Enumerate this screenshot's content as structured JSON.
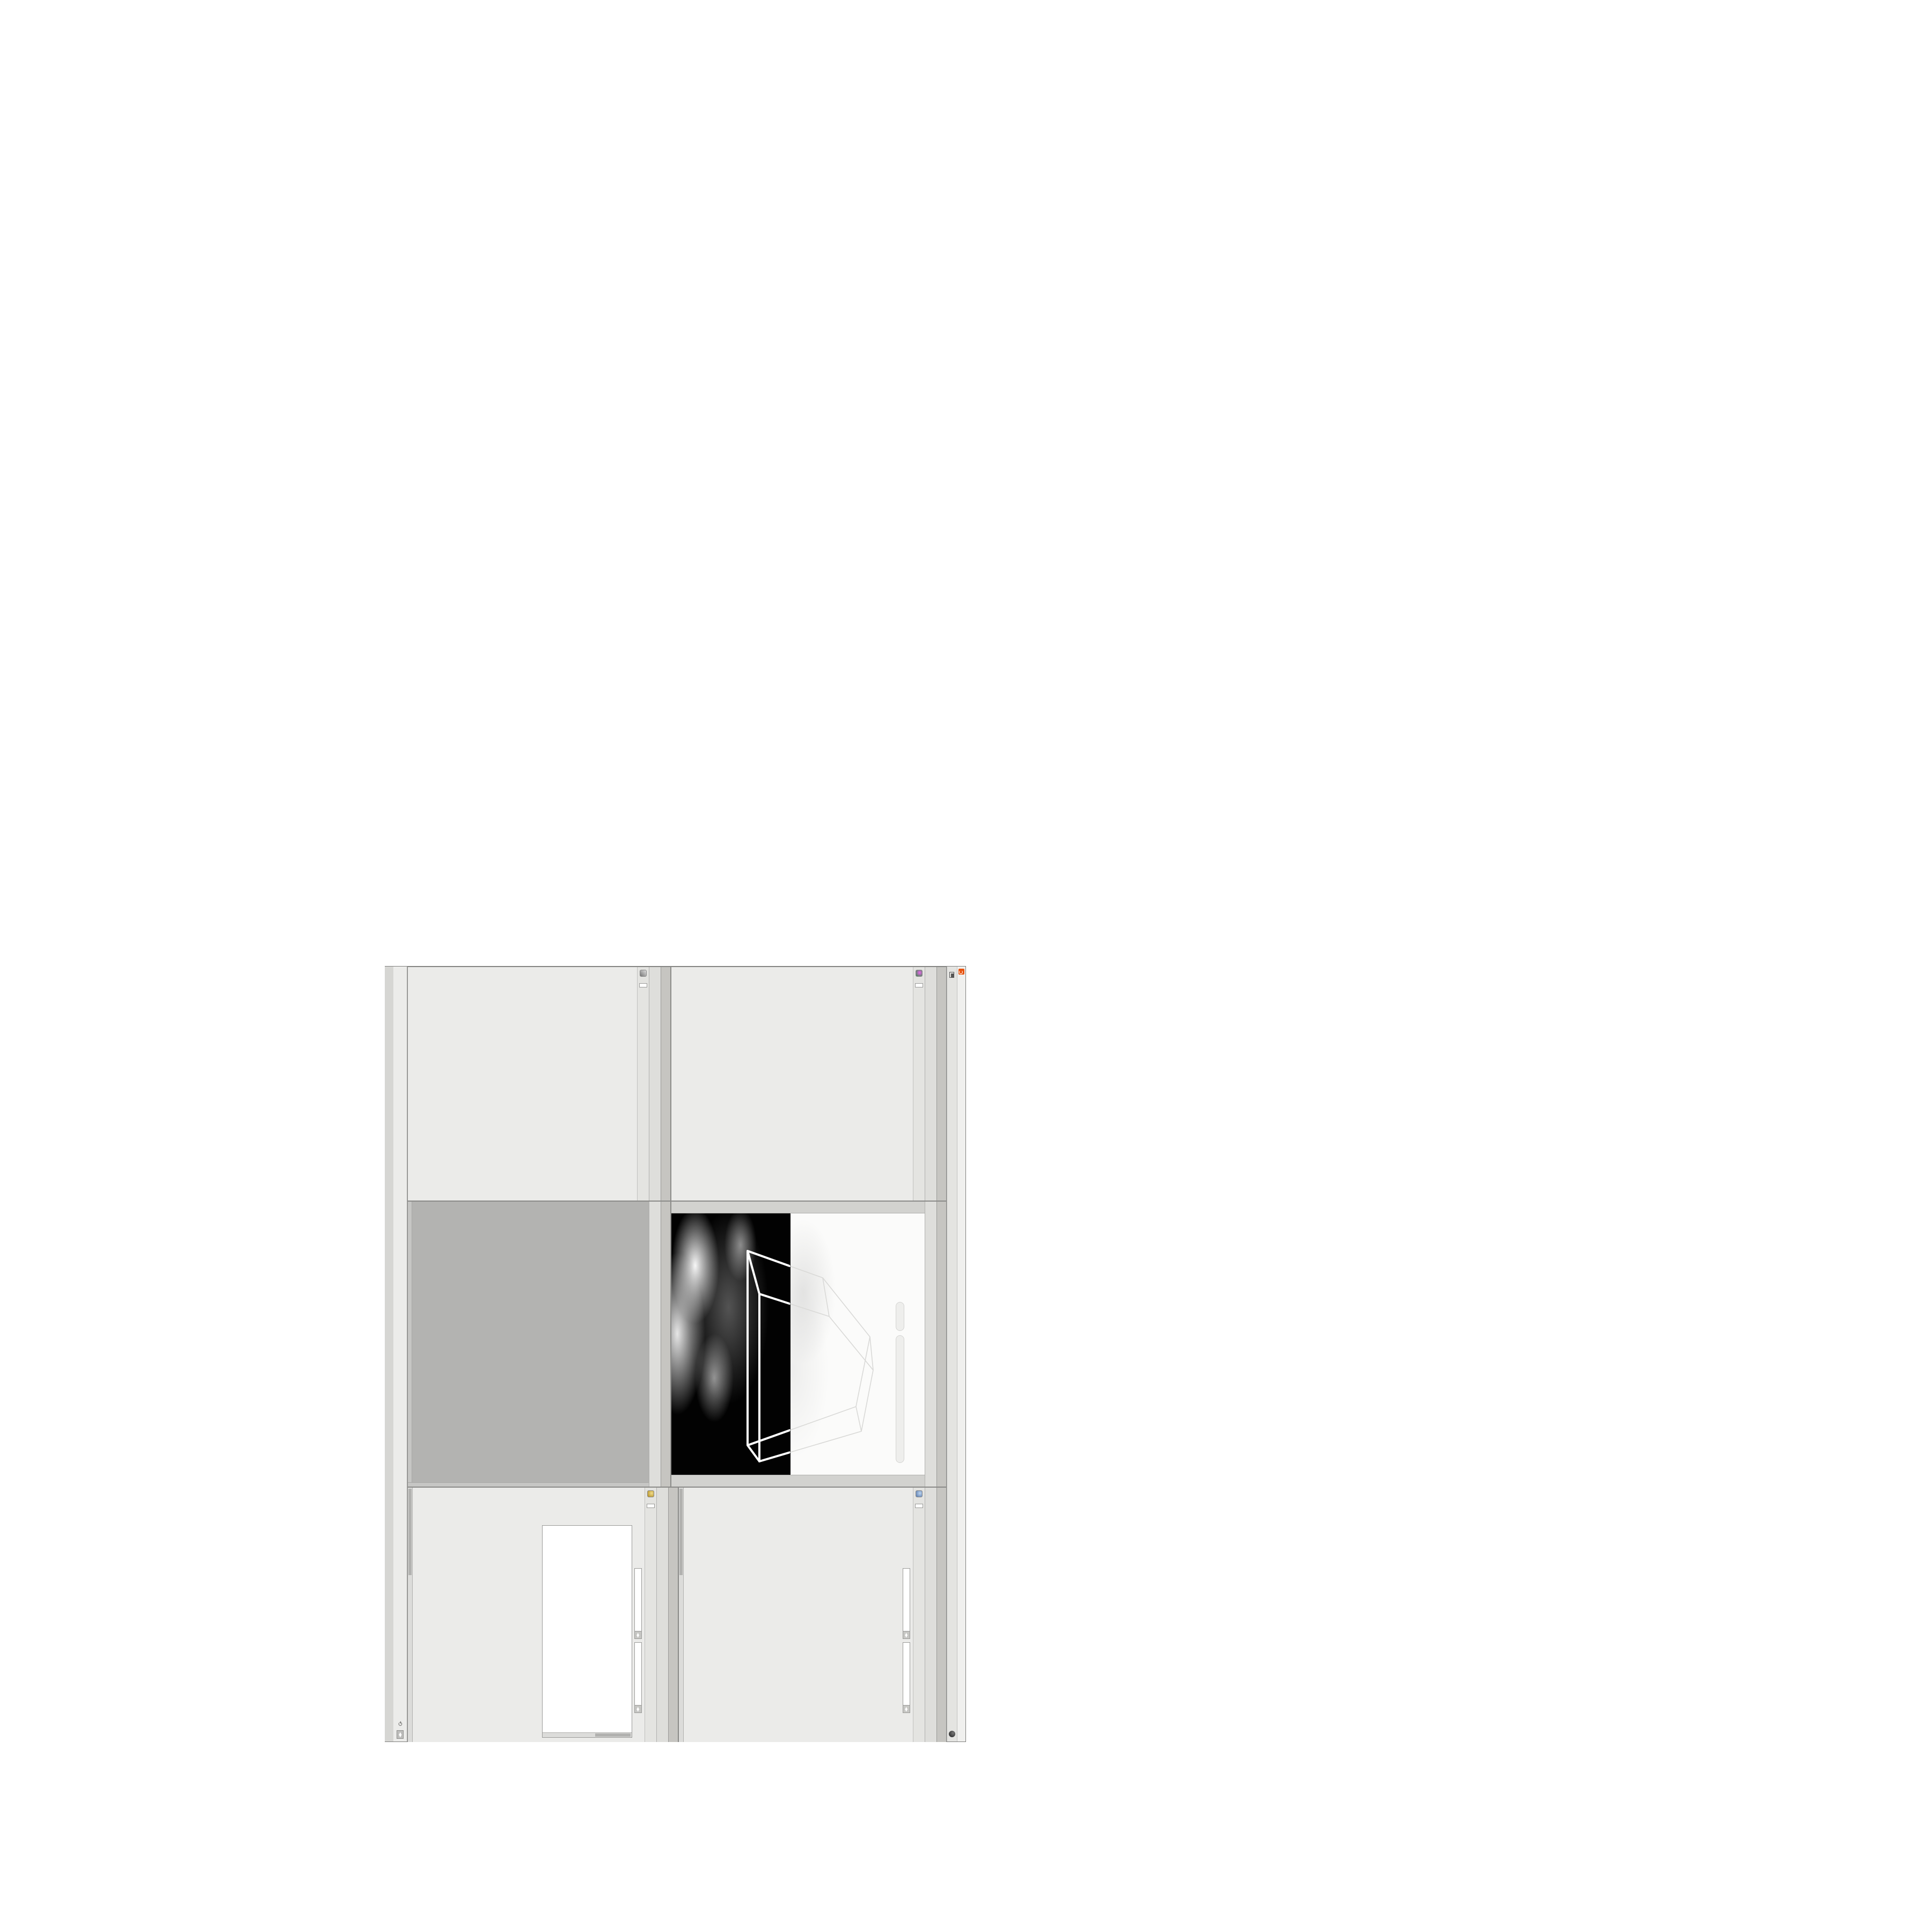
{
  "window": {
    "title": "C:/O/O_AIDIV_O_VIDIA_O/O_INIDUOH_O_HOUDINI_O/O_5_71_O_17_5_O/O_PIH_O_HIP_O/PIH.O___#5_71#___#WOLG#_#BDV#___O___#VDB#_#GLOW#___#17_5#___O.HIP - Houdini FX 17.5.460",
    "menu": [
      "File",
      "Edit",
      "Render",
      "Assets",
      "Windows",
      "Help"
    ],
    "desktop_label": "O",
    "right_label": "Main",
    "buttons": [
      "–",
      "❐",
      "✕"
    ]
  },
  "breadcrumb": {
    "root": "obj",
    "path": "O_YRTEMOEG_O_GEOMETRY_O"
  },
  "nav_icons": [
    "*",
    "H",
    "○",
    "i",
    "?"
  ],
  "statusbar": {
    "message": "Successfully saved PIH.O___#5_71#___#WOLG#_#BDV#___O___#VDB#_#GLOW#___#17_5#___O.HIP (Thu Feb 4 10:46:01 2021)",
    "auto_update": "Auto Update"
  },
  "volviz": {
    "tabs": [
      "O____ARTNAM_...",
      "O____AREMAC_...",
      "O_NOITAZILAUSIV..."
    ],
    "active_tab": 2,
    "node_type": "Volume Visualization",
    "node_name": "O_NOITAZILAUSIV_EMULO",
    "rows1": [
      {
        "label": "Density Field",
        "value": "density",
        "w": 130
      },
      {
        "label": "Mode",
        "value": "Clamped...",
        "dd": true,
        "w": 92,
        "extra": "Density",
        "btn": "Presets"
      }
    ],
    "ramp1_label": "Density Ramp",
    "rows2": [
      {
        "label": "Diffuse Field",
        "value": "density",
        "w": 130
      },
      {
        "label": "Mode",
        "value": "Clamped R...",
        "dd": true,
        "w": 92,
        "extra": "Diffuse",
        "btn": "Presets"
      },
      {
        "label": "Diffuse Range",
        "value": "0",
        "value2": "1",
        "w": 44,
        "dim": true
      }
    ],
    "ramp2_label": "Diffuse Ramp",
    "rows3": [
      {
        "label": "Point No.",
        "value": "1",
        "w": 56,
        "slider": 0.06
      },
      {
        "label": "Position",
        "value": "0",
        "w": 56,
        "slider": 0.04
      },
      {
        "label": "Color",
        "swatch": true
      }
    ],
    "hsv": [
      {
        "label": "H",
        "value": "0",
        "ramp": "hue"
      },
      {
        "label": "S",
        "value": "0",
        "ramp": "sat"
      },
      {
        "label": "V",
        "value": "1.8125",
        "ramp": "val"
      }
    ],
    "rows4": [
      {
        "label": "Interpolation",
        "value": "Linear",
        "dd": true,
        "w": 104
      }
    ]
  },
  "switchpane": {
    "tabs": [
      "O_HCTIWS_NOITAZILAUSIV_ECILS_ELDIM_O_MIDLE_SLICE_VISUAL..."
    ],
    "active_tab": 0,
    "node_type": "Switch",
    "node_name": "O_HCTIWS_NOITAZILAUSIV_ECILS_EL",
    "list_label": "Input Operators (Drag/Drop to reorder)",
    "inputs": [
      "O_NOITAZILAUSIV_EMULOV_O_VOLUME_VISUALIZATION_O",
      "O_MROFSNART_ECILS_ELDIM_O_MIDLE_SLICE_TRANSFORM_O"
    ],
    "select": {
      "label": "Select Input",
      "value": "0",
      "w": 50,
      "slider": 0.03
    }
  },
  "viewport": {
    "tab": "Main",
    "ortho_pill": "Ortho ▾",
    "camera_pill": "O____AREMAC____O____CAMERA____O ▾",
    "left_toolbar": [
      "view-light-a",
      "view-light-b",
      "view-light-c",
      "select-tool",
      "translate-tool",
      "rotate-tool",
      "scale-tool",
      "handles-tool",
      "snap-magnet",
      "snap-grid",
      "secure-selection"
    ],
    "right_toolbar": [
      "camera-lock",
      "quadview-grid",
      "display-points",
      "display-wire",
      "display-shaded",
      "display-volume",
      "grid-toggle",
      "ruler-tool",
      "light-toggle",
      "material-toggle"
    ]
  },
  "network": {
    "tabs": [
      "O_YRTEMOEG_O_GEOMETRY_O"
    ],
    "active_tab": 0,
    "watermark": "Geometry",
    "nodes": [
      {
        "type": "an_CubeSphere",
        "name": "O_EREHPS_EBUC_O_CUBE_SPHERE_O",
        "c": "#4a8f5a"
      },
      {
        "type": "PolyWire",
        "name": "O_EMARFERIW_NOGYLOP_EREHPS_EBUC_O_CUBE_SPHERE_POLYGON_WIREFRAME_O",
        "c": "#8a8a88"
      },
      {
        "type": "File",
        "name": "JBO.M03.PETS.TRPG.LS_O_SL.GPRT.STEP.30M.OBJ",
        "c": "#e0893a"
      },
      {
        "type": "Switch",
        "name": "O_HCTIWS_YRTEMOEG_LANRETXE_LANRETNI_O_INTERNAL_EXTERNAL_GEOMETRY_SWITCH_O",
        "c": "#6a6a68"
      },
      {
        "type": "Clip",
        "name": "O_EMULOV_PILC_TNORF_O_FRONT_CLIP_VOLUME_O",
        "c": "#9a9ab8"
      },
      {
        "type": "Clip",
        "name": "O_EMULOV_PILC_KCAB_O_BACK_CLIP_VOLUME_O",
        "c": "#9a9ab8"
      },
      {
        "type": "FLIP Source",
        "name": "O_EMULOV_LEHS_ELCITRAP_TICILPMI_DIULF_O_FLUID_IMPLICIT_PARTICLE_SHEL_VOLUME_O",
        "c": "#f2f2f0"
      },
      {
        "type": "VDB from Polygons",
        "name": "O_SNOGYLOP_YRTEMOEG_MORF_EMULOV_BDV_O_VDB_VOLUME_FROM_GEOMETRY_POLYGONS_O",
        "c": "#9aa7d8"
      },
      {
        "type": "Volume Wrangle",
        "name": "O____ELGNARW_EMULOV____O____VOLUME_WRANGLE____O",
        "c": "#c9a227"
      },
      {
        "type": "Volume Visualization",
        "name": "O_NOITAZILAUSIV_EMULOV_O_VOLUME_VISUALIZATION_O",
        "c": "#cc5577"
      },
      {
        "type": "Transform",
        "name": "O_MROFSNART_ECILS_ELDIM_O_MIDLE_SLICE_TRANSFORM_O",
        "c": "#8a8a88"
      },
      {
        "type": "Switch",
        "name": "O_HCTIWS_NOITAZILAUSIV_ECILS_ELDIM_O_MIDLE_SLICE_VISUALIZATION_SWITCH_O",
        "c": "#6a6a68"
      },
      {
        "type": "Merge",
        "name": "O_ECAFRUS_HTIW_EMULOV_EGREM_O_MERGE_VOLUME_WITH_SURFACE_O",
        "c": "#f2f2f0"
      },
      {
        "type": "Transform",
        "name": "O_MROFSNART_TLUSER_O_RESULT_TRANSFORM_O",
        "c": "#b0b0ae",
        "selected": true
      }
    ]
  },
  "flip": {
    "tabs": [
      "O_EMULOV_LEHS_ELCITRAP_TICILPMI_DIULF_O_FLUID_IMPLICIT_PARTI..."
    ],
    "active_tab": 0,
    "node_type": "FLIP Source",
    "node_name": "O_EMULOV_LEHS_ELCITRAP_TICI",
    "asset_label": "Asset Name and Path",
    "asset_name": "flipsource",
    "asset_path": "C:/O/O_ERAWTF...",
    "rows": [
      {
        "label": "Initialize",
        "value": "Source FLIP",
        "dd": true,
        "w": 104
      },
      {
        "label": "Volume Name",
        "value": "density",
        "w": 140
      },
      {
        "label": "Voxel Size",
        "value": "1/27",
        "w": 76,
        "yellow": true,
        "slider": 0.34,
        "sw": 150
      },
      {
        "label": "Shell Thickness",
        "value": "3",
        "w": 76,
        "slider": 0.56,
        "sw": 150
      },
      {
        "label": "Output Fog",
        "chk": true
      },
      {
        "label": "Fog Boost",
        "value": "0",
        "w": 76,
        "dim": true,
        "slider": 0.05,
        "sw": 150
      }
    ],
    "group_label": "Particles",
    "group_rows": [
      {
        "label": "Create Particles",
        "chk": true,
        "bold": true
      },
      {
        "label": "Particle Group",
        "value": "particles",
        "w": 140,
        "dim": true
      },
      {
        "label": "Particle Separation",
        "value": "1/9",
        "w": 76,
        "dim": true,
        "slider": 0.3,
        "sw": 130
      },
      {
        "label": "Jitter Seed",
        "value": "0",
        "w": 76,
        "dim": true,
        "slider": 0.05,
        "sw": 130
      },
      {
        "label": "Jitter Scale",
        "value": "0",
        "w": 76,
        "dim": true,
        "slider": 0.05,
        "sw": 130
      },
      {
        "label": "Oversampling",
        "value": "2",
        "w": 76,
        "dim": true,
        "slider": 0.12,
        "sw": 130
      },
      {
        "label": "Oversampling Bandwi...",
        "value": "1",
        "w": 76,
        "dim": true,
        "slider": 0.08,
        "sw": 130
      },
      {
        "label": "Velocity",
        "value": "0",
        "w": 76,
        "dim": true
      }
    ],
    "rows_after": [
      {
        "label": "Add Rest Attribute",
        "chk": true
      }
    ]
  },
  "wrangle": {
    "tabs": [
      "O____ELGNARW_EMULOV____O____VOLUME_WRANGL..."
    ],
    "active_tab": 0,
    "node_type": "Volume Wrangle",
    "node_name": "O____ELGNARW_EMULOV____O",
    "asset_label": "Asset Name and Path",
    "asset_name": "volumewrangle",
    "asset_path": "C:/O/O_ERAWTF...",
    "rows": [
      {
        "label": "Volumes to Write to",
        "value": "*",
        "w": 96
      },
      {
        "label": "Enforce Prototypes",
        "chk": true
      }
    ],
    "code": [
      "//@density=(   -pow(   clamp(   (cos(@O_ELACS_",
      "//@density=(   -pow(    (cos(@O_ELACS_O_SCAL",
      "//@density=((   (   -pow(   clamp(   (cos(1*$",
      "//@density=(   -pow(    (cos((clamp(@O_TFIHS",
      "//@density=((   (   -pow(   clamp(   (cos( c",
      "//@density=((       (pow((        1./",
      "//@density=((pow((    1./ (1.-clamp(",
      "@density=((       ((pow((    1./ ("
    ],
    "cursor": "Ln 1, Col 1",
    "sliders": [
      {
        "label": "O_REWOP_O_POWER...",
        "value": "6",
        "slider": 0.42
      },
      {
        "label": "O_ELACS_O_SCALE_O",
        "value": "32",
        "slider": 0.78
      },
      {
        "label": "O_TFIHS_O_SHIFT_O",
        "value": "1.4375",
        "slider": 0.16
      }
    ]
  }
}
